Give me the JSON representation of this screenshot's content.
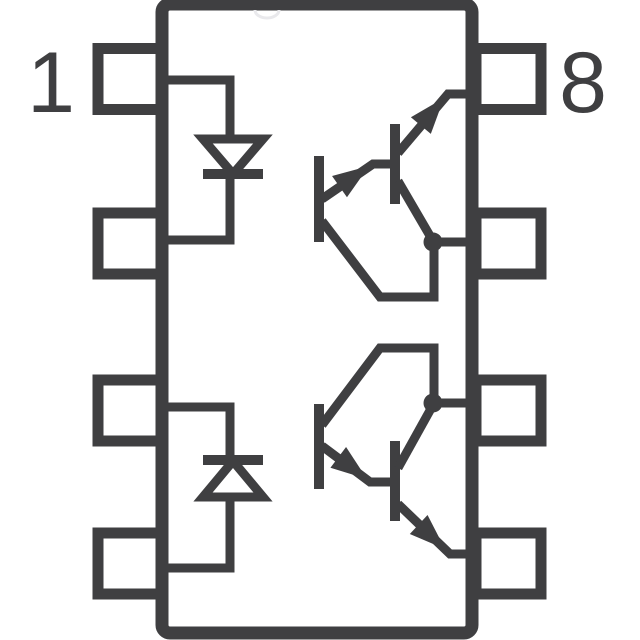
{
  "colors": {
    "line": "#3f3f41",
    "bg": "#ffffff",
    "notch": "#e9e9ec"
  },
  "package": {
    "description": "8-pin dual-channel optocoupler schematic symbol",
    "pin_labels": {
      "pin1": "1",
      "pin8": "8"
    }
  },
  "icons": {
    "led_channel_1": "diode-triangle-pointing-down",
    "led_channel_2": "diode-triangle-pointing-up",
    "output_channel_1": "npn-darlington-pair-arrows-up",
    "output_channel_2": "npn-darlington-pair-arrows-down",
    "junction_1": "connection-dot",
    "junction_2": "connection-dot",
    "package_mark": "top-notch"
  }
}
